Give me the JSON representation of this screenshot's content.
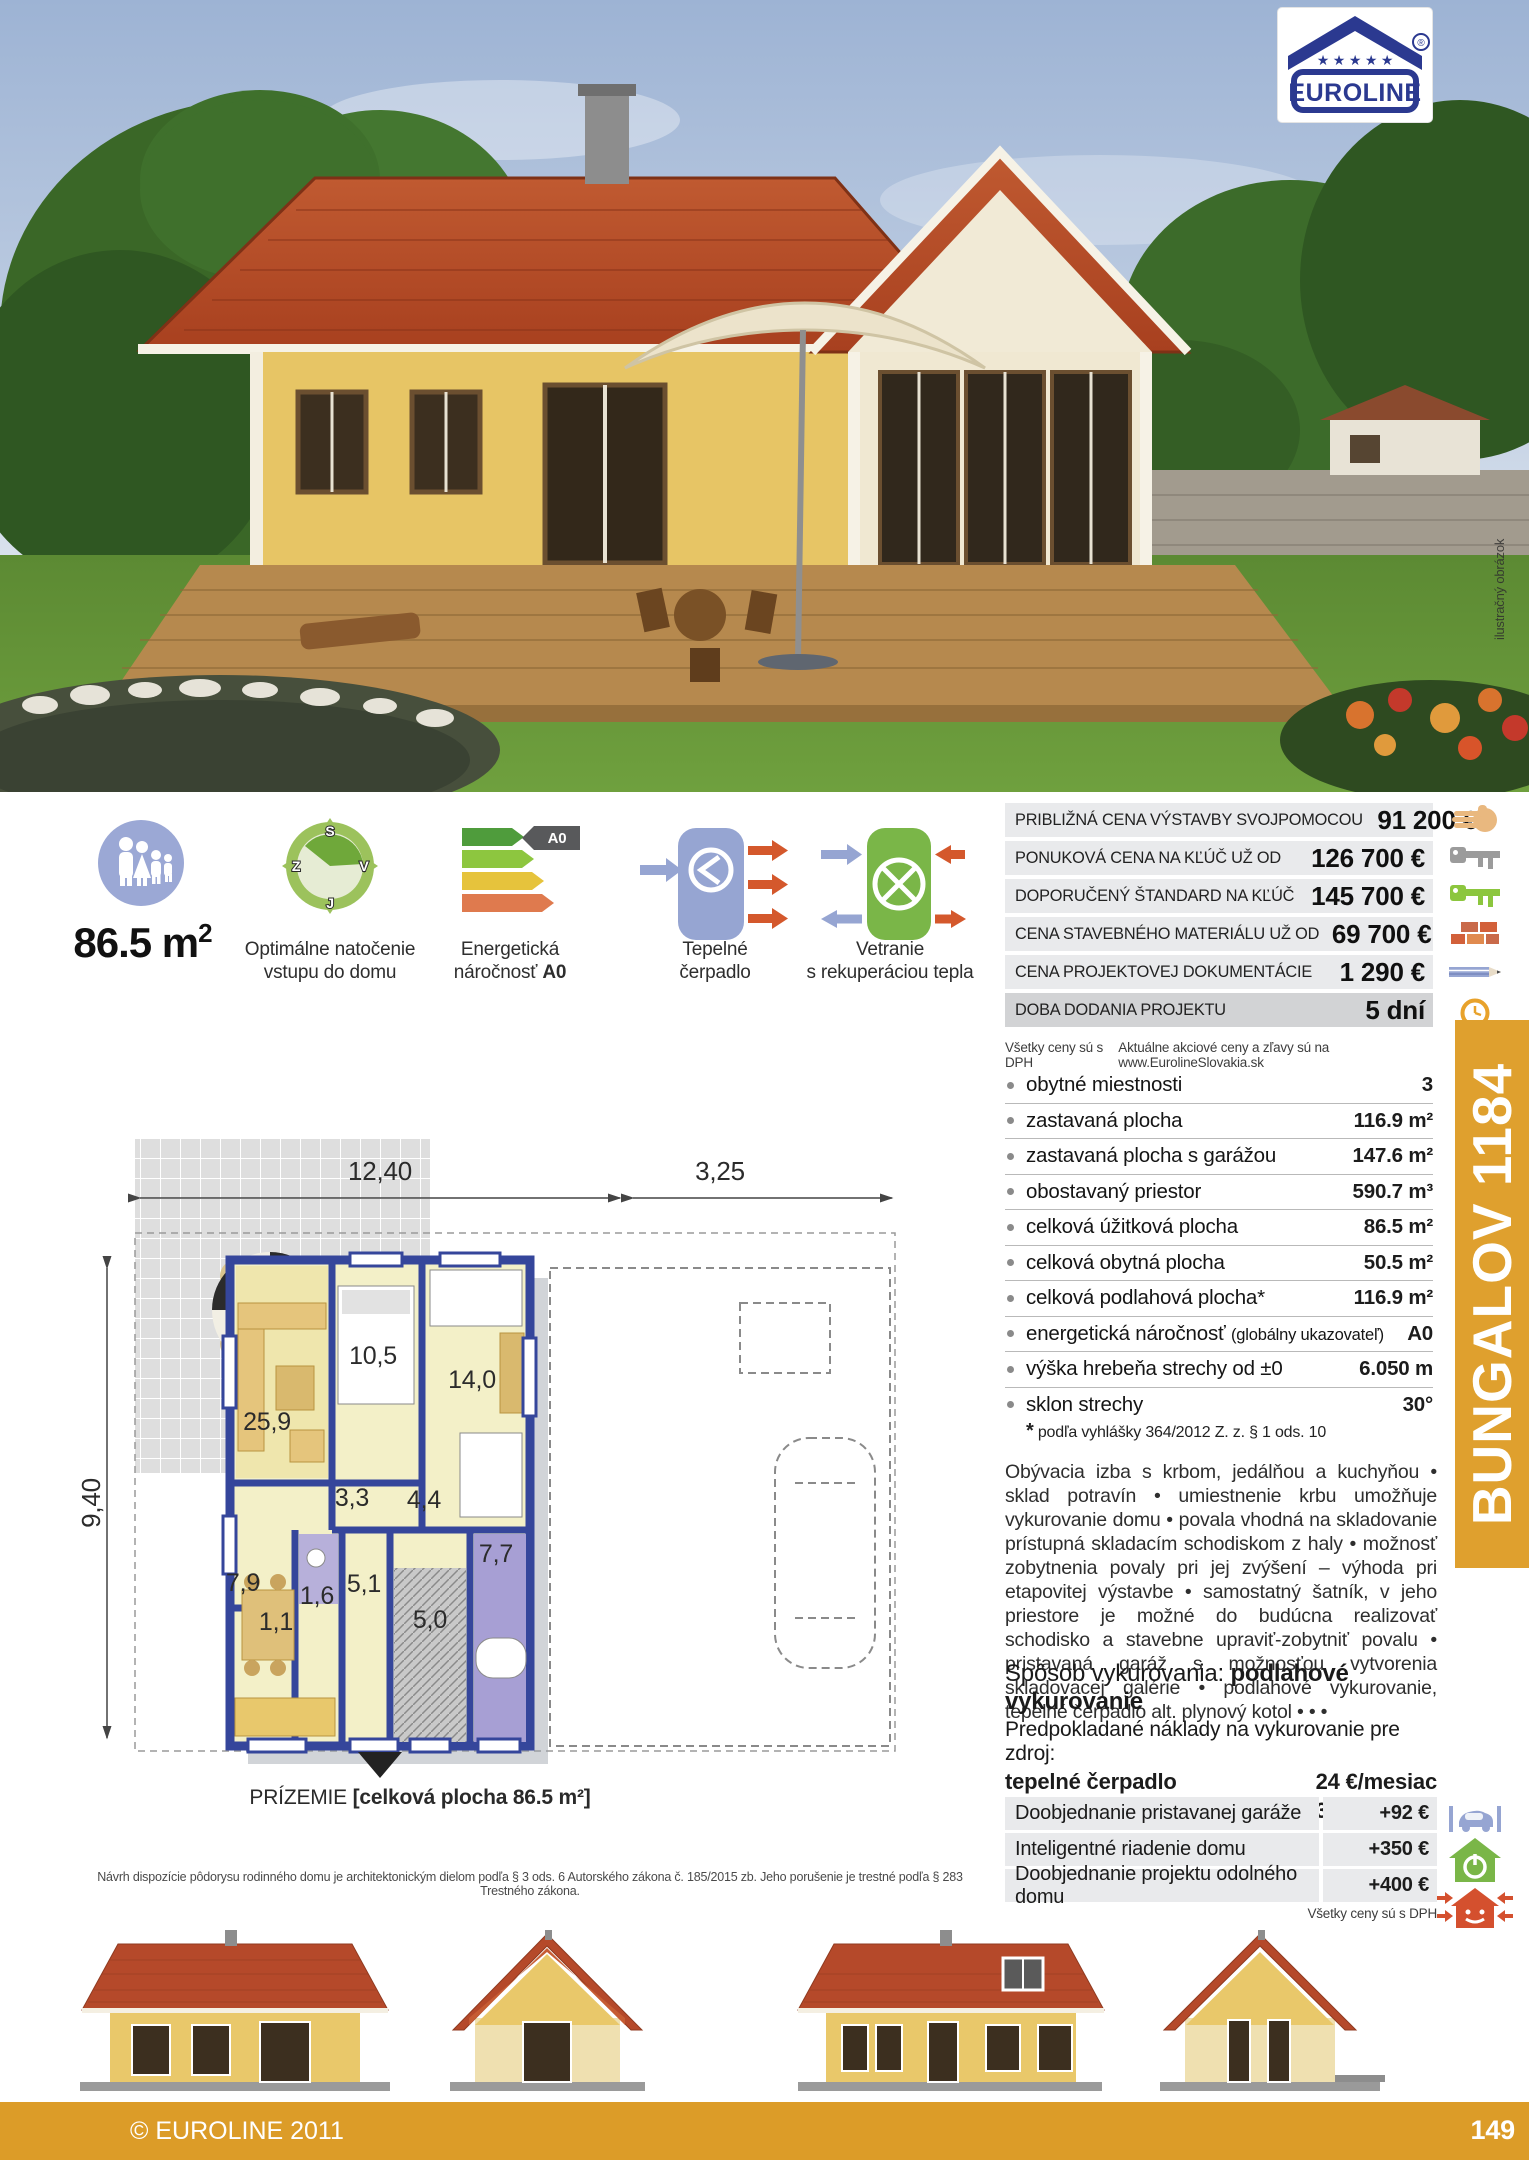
{
  "brand": {
    "logo_text": "EUROLINE",
    "registered": "®",
    "stars": "★ ★ ★ ★ ★"
  },
  "photo": {
    "note": "ilustračný obrázok"
  },
  "features": {
    "area": {
      "value": "86.5 m",
      "sup": "2"
    },
    "compass": {
      "n": "S",
      "w": "Z",
      "e": "V",
      "s": "J",
      "caption1": "Optimálne natočenie",
      "caption2": "vstupu do domu"
    },
    "energy": {
      "badge": "A0",
      "caption1": "Energetická",
      "caption2_pre": "náročnosť",
      "caption2_bold": "A0"
    },
    "heatpump": {
      "caption1": "Tepelné",
      "caption2": "čerpadlo"
    },
    "ventilation": {
      "caption1": "Vetranie",
      "caption2": "s rekuperáciou tepla"
    }
  },
  "prices": {
    "rows": [
      {
        "label": "PRIBLIŽNÁ CENA VÝSTAVBY SVOJPOMOCOU",
        "value": "91 200 €",
        "icon": "hand-icon"
      },
      {
        "label": "PONUKOVÁ CENA NA KĽÚČ UŽ OD",
        "value": "126 700 €",
        "icon": "key-gray-icon"
      },
      {
        "label": "DOPORUČENÝ ŠTANDARD NA KĽÚČ",
        "value": "145 700 €",
        "icon": "key-green-icon"
      },
      {
        "label": "CENA STAVEBNÉHO MATERIÁLU UŽ OD",
        "value": "69 700 €",
        "icon": "bricks-icon"
      },
      {
        "label": "CENA PROJEKTOVEJ DOKUMENTÁCIE",
        "value": "1 290 €",
        "icon": "pencil-icon"
      },
      {
        "label": "DOBA DODANIA PROJEKTU",
        "value": "5 dní",
        "icon": "clock-icon"
      }
    ],
    "note_left": "Všetky ceny sú s DPH",
    "note_right": "Aktuálne akciové ceny a zľavy sú na www.EurolineSlovakia.sk"
  },
  "specs": {
    "rows": [
      {
        "label": "obytné miestnosti",
        "value": "3"
      },
      {
        "label": "zastavaná plocha",
        "value": "116.9 m²"
      },
      {
        "label": "zastavaná plocha s garážou",
        "value": "147.6 m²"
      },
      {
        "label": "obostavaný priestor",
        "value": "590.7 m³"
      },
      {
        "label": "celková úžitková plocha",
        "value": "86.5 m²"
      },
      {
        "label": "celková obytná plocha",
        "value": "50.5 m²"
      },
      {
        "label": "celková podlahová plocha*",
        "value": "116.9 m²"
      },
      {
        "label": "energetická náročnosť",
        "note": "(globálny ukazovateľ)",
        "value": "A0"
      },
      {
        "label": "výška hrebeňa strechy od ±0",
        "value": "6.050 m"
      },
      {
        "label": "sklon strechy",
        "value": "30°"
      }
    ],
    "footnote_star": "*",
    "footnote": "podľa vyhlášky 364/2012 Z. z. § 1 ods. 10"
  },
  "model": {
    "name": "BUNGALOV 1184"
  },
  "description": "Obývacia izba s krbom, jedálňou a kuchyňou • sklad potravín • umiestnenie krbu umožňuje vykurovanie domu • povala vhodná na skladovanie prístupná skladacím schodiskom z haly • možnosť zobytnenia povaly pri jej zvýšení – výhoda pri etapovitej výstavbe • samostatný šatník, v jeho priestore je možné do budúcna realizovať schodisko a stavebne upraviť-zobytniť povalu • pristavaná garáž s možnosťou vytvorenia skladovacej galérie • podlahové vykurovanie, tepelné čerpadlo alt. plynový kotol • • •",
  "heating": {
    "line1_label": "Spôsob vykurovania:",
    "line1_value": "podlahové vykurovanie",
    "line2": "Predpokladané náklady na vykurovanie pre zdroj:",
    "rows": [
      {
        "label": "tepelné čerpadlo",
        "value": "24 €/mesiac"
      },
      {
        "label": "plynový kotol",
        "value": "32 €/mesiac"
      }
    ]
  },
  "addons": {
    "rows": [
      {
        "label": "Doobjednanie pristavanej garáže",
        "value": "+92 €",
        "icon": "garage-car-icon"
      },
      {
        "label": "Inteligentné riadenie domu",
        "value": "+350 €",
        "icon": "smart-home-icon"
      },
      {
        "label": "Doobjednanie projektu odolného domu",
        "value": "+400 €",
        "icon": "resilient-home-icon"
      }
    ],
    "note": "Všetky ceny sú s DPH"
  },
  "floorplan": {
    "dim_width": "12,40",
    "dim_garage": "3,25",
    "dim_depth": "9,40",
    "rooms": {
      "living": "25,9",
      "bedroom1": "10,5",
      "bedroom2": "14,0",
      "bath_small": "3,3",
      "closet": "4,4",
      "kitchen": "7,9",
      "wc": "1,6",
      "pantry": "1,1",
      "hall": "5,1",
      "tech": "5,0",
      "bath": "7,7"
    },
    "caption_title": "PRÍZEMIE",
    "caption_detail": "[celková plocha 86.5 m²]"
  },
  "legal": "Návrh dispozície pôdorysu rodinného domu je architektonickým dielom podľa § 3 ods. 6 Autorského zákona č. 185/2015 zb. Jeho porušenie je trestné podľa § 283 Trestného zákona.",
  "footer": {
    "copyright": "© EUROLINE 2011",
    "page": "149"
  },
  "colors": {
    "accent_orange": "#dfa02e",
    "wall_blue": "#35469b",
    "photo_roof": "#b5492a"
  }
}
